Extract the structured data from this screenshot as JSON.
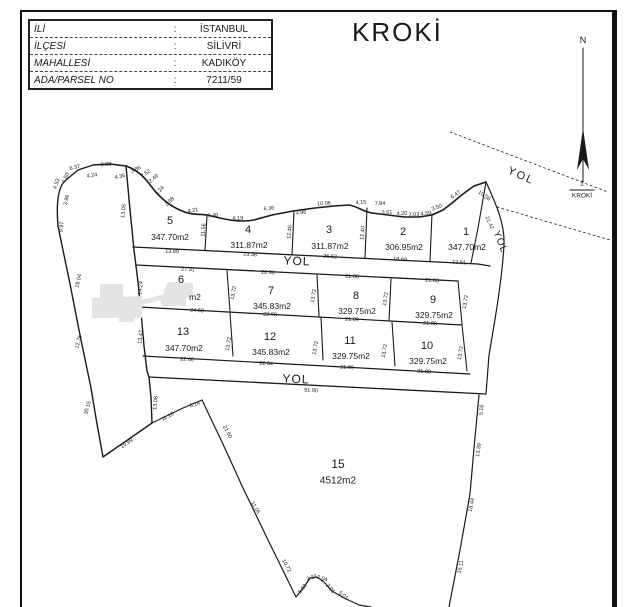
{
  "info_table": {
    "rows": [
      {
        "label": "İLİ",
        "sep": ":",
        "value": "İSTANBUL"
      },
      {
        "label": "İLÇESİ",
        "sep": ":",
        "value": "SİLİVRİ"
      },
      {
        "label": "MAHALLESİ",
        "sep": ":",
        "value": "KADIKÖY"
      },
      {
        "label": "ADA/PARSEL NO",
        "sep": ":",
        "value": "7211/59"
      }
    ]
  },
  "title": "KROKİ",
  "north_label": "N",
  "scale": {
    "numerator": "1",
    "denominator": "KROKİ"
  },
  "colors": {
    "ink": "#1a1a1a",
    "blob": "#e4e4e4",
    "paper": "#ffffff"
  },
  "map": {
    "parcels": [
      {
        "no": "5",
        "area": "347.70m2",
        "nx": 170,
        "ny": 221,
        "ax": 170,
        "ay": 237
      },
      {
        "no": "4",
        "area": "311.87m2",
        "nx": 248,
        "ny": 230,
        "ax": 249,
        "ay": 245
      },
      {
        "no": "3",
        "area": "311.87m2",
        "nx": 329,
        "ny": 230,
        "ax": 330,
        "ay": 246
      },
      {
        "no": "2",
        "area": "306.95m2",
        "nx": 403,
        "ny": 232,
        "ax": 404,
        "ay": 247
      },
      {
        "no": "1",
        "area": "347.70m2",
        "nx": 466,
        "ny": 232,
        "ax": 467,
        "ay": 247
      },
      {
        "no": "6",
        "area": "m2",
        "nx": 181,
        "ny": 280,
        "ax": 195,
        "ay": 297
      },
      {
        "no": "7",
        "area": "345.83m2",
        "nx": 271,
        "ny": 291,
        "ax": 272,
        "ay": 306
      },
      {
        "no": "8",
        "area": "329.75m2",
        "nx": 356,
        "ny": 296,
        "ax": 357,
        "ay": 311
      },
      {
        "no": "9",
        "area": "329.75m2",
        "nx": 433,
        "ny": 300,
        "ax": 434,
        "ay": 315
      },
      {
        "no": "13",
        "area": "347.70m2",
        "nx": 183,
        "ny": 332,
        "ax": 184,
        "ay": 348
      },
      {
        "no": "12",
        "area": "345.83m2",
        "nx": 270,
        "ny": 337,
        "ax": 271,
        "ay": 352
      },
      {
        "no": "11",
        "area": "329.75m2",
        "nx": 350,
        "ny": 341,
        "ax": 351,
        "ay": 356
      },
      {
        "no": "10",
        "area": "329.75m2",
        "nx": 427,
        "ny": 346,
        "ax": 428,
        "ay": 361
      },
      {
        "no": "15",
        "area": "4512m2",
        "nx": 338,
        "ny": 464,
        "ax": 338,
        "ay": 481,
        "ns": 12,
        "as": 10
      }
    ],
    "road_labels": [
      {
        "t": "YOL",
        "x": 297,
        "y": 261,
        "r": 2,
        "s": 12
      },
      {
        "t": "YOL",
        "x": 296,
        "y": 379,
        "r": 2,
        "s": 12
      },
      {
        "t": "YOL",
        "x": 521,
        "y": 176,
        "r": 24,
        "s": 11,
        "ls": 2
      },
      {
        "t": "YOL",
        "x": 500,
        "y": 242,
        "r": 68,
        "s": 10,
        "ls": 1
      }
    ],
    "dim_labels": [
      {
        "t": "6.37",
        "x": 75,
        "y": 168,
        "r": -14
      },
      {
        "t": "3.88",
        "x": 106,
        "y": 165,
        "r": -4
      },
      {
        "t": "4.24",
        "x": 92,
        "y": 176,
        "r": -8
      },
      {
        "t": "4.36",
        "x": 120,
        "y": 177,
        "r": -12
      },
      {
        "t": "3.86",
        "x": 136,
        "y": 170,
        "r": -25
      },
      {
        "t": "2.52",
        "x": 146,
        "y": 174,
        "r": -35
      },
      {
        "t": "2.49",
        "x": 154,
        "y": 179,
        "r": -40
      },
      {
        "t": "4.53",
        "x": 57,
        "y": 184,
        "r": -72
      },
      {
        "t": "1.50",
        "x": 66,
        "y": 178,
        "r": -65
      },
      {
        "t": "3.96",
        "x": 67,
        "y": 200,
        "r": -78
      },
      {
        "t": "9.97",
        "x": 62,
        "y": 227,
        "r": -84
      },
      {
        "t": "19.04",
        "x": 79,
        "y": 281,
        "r": -78
      },
      {
        "t": "12.76",
        "x": 79,
        "y": 342,
        "r": -75
      },
      {
        "t": "30.15",
        "x": 88,
        "y": 408,
        "r": -74
      },
      {
        "t": "3.24",
        "x": 160,
        "y": 191,
        "r": -48
      },
      {
        "t": "2.98",
        "x": 170,
        "y": 202,
        "r": -45
      },
      {
        "t": "4.21",
        "x": 193,
        "y": 211,
        "r": -10
      },
      {
        "t": "7.46",
        "x": 213,
        "y": 216,
        "r": -6
      },
      {
        "t": "8.19",
        "x": 238,
        "y": 219,
        "r": -4
      },
      {
        "t": "6.36",
        "x": 269,
        "y": 209,
        "r": -6
      },
      {
        "t": "3.96",
        "x": 301,
        "y": 213,
        "r": -4
      },
      {
        "t": "10.06",
        "x": 324,
        "y": 204,
        "r": -3
      },
      {
        "t": "4.15",
        "x": 361,
        "y": 203,
        "r": -3
      },
      {
        "t": "7.84",
        "x": 380,
        "y": 204,
        "r": -3
      },
      {
        "t": "3.61",
        "x": 387,
        "y": 213,
        "r": -3
      },
      {
        "t": "4.20",
        "x": 402,
        "y": 214,
        "r": -3
      },
      {
        "t": "2.03",
        "x": 414,
        "y": 215,
        "r": -3
      },
      {
        "t": "4.59",
        "x": 426,
        "y": 214,
        "r": -6
      },
      {
        "t": "3.50",
        "x": 437,
        "y": 208,
        "r": -22
      },
      {
        "t": "6.47",
        "x": 456,
        "y": 195,
        "r": -35
      },
      {
        "t": "10.56",
        "x": 484,
        "y": 196,
        "r": 35
      },
      {
        "t": "13.05",
        "x": 124,
        "y": 211,
        "r": -84
      },
      {
        "t": "11.56",
        "x": 204,
        "y": 230,
        "r": -85
      },
      {
        "t": "12.46",
        "x": 290,
        "y": 232,
        "r": -85
      },
      {
        "t": "12.40",
        "x": 363,
        "y": 233,
        "r": -85
      },
      {
        "t": "13.89",
        "x": 172,
        "y": 252,
        "r": 3
      },
      {
        "t": "23.38",
        "x": 250,
        "y": 255,
        "r": 3
      },
      {
        "t": "26.62",
        "x": 330,
        "y": 257,
        "r": 3
      },
      {
        "t": "18.69",
        "x": 400,
        "y": 260,
        "r": 3
      },
      {
        "t": "12.51",
        "x": 459,
        "y": 263,
        "r": 3
      },
      {
        "t": "27.31",
        "x": 188,
        "y": 270,
        "r": 3
      },
      {
        "t": "22.96",
        "x": 268,
        "y": 273,
        "r": 3
      },
      {
        "t": "21.88",
        "x": 352,
        "y": 277,
        "r": 3
      },
      {
        "t": "21.83",
        "x": 432,
        "y": 281,
        "r": 3
      },
      {
        "t": "14.24",
        "x": 141,
        "y": 288,
        "r": -84
      },
      {
        "t": "13.72",
        "x": 234,
        "y": 293,
        "r": -80
      },
      {
        "t": "13.72",
        "x": 314,
        "y": 296,
        "r": -80
      },
      {
        "t": "13.72",
        "x": 386,
        "y": 299,
        "r": -80
      },
      {
        "t": "13.72",
        "x": 466,
        "y": 302,
        "r": -80
      },
      {
        "t": "24.50",
        "x": 197,
        "y": 311,
        "r": 3
      },
      {
        "t": "22.98",
        "x": 270,
        "y": 315,
        "r": 3
      },
      {
        "t": "21.89",
        "x": 352,
        "y": 320,
        "r": 3
      },
      {
        "t": "21.88",
        "x": 430,
        "y": 324,
        "r": 3
      },
      {
        "t": "13.47",
        "x": 141,
        "y": 337,
        "r": -84
      },
      {
        "t": "13.72",
        "x": 229,
        "y": 344,
        "r": -80
      },
      {
        "t": "13.72",
        "x": 316,
        "y": 348,
        "r": -80
      },
      {
        "t": "13.72",
        "x": 385,
        "y": 351,
        "r": -80
      },
      {
        "t": "13.72",
        "x": 461,
        "y": 353,
        "r": -80
      },
      {
        "t": "22.60",
        "x": 187,
        "y": 360,
        "r": 3
      },
      {
        "t": "22.64",
        "x": 266,
        "y": 364,
        "r": 3
      },
      {
        "t": "21.89",
        "x": 347,
        "y": 368,
        "r": 3
      },
      {
        "t": "21.88",
        "x": 424,
        "y": 372,
        "r": 3
      },
      {
        "t": "91.90",
        "x": 311,
        "y": 391,
        "r": 3
      },
      {
        "t": "21.42",
        "x": 489,
        "y": 223,
        "r": 65
      },
      {
        "t": "13.08",
        "x": 156,
        "y": 403,
        "r": -85
      },
      {
        "t": "10.99",
        "x": 127,
        "y": 444,
        "r": -33
      },
      {
        "t": "11.10",
        "x": 168,
        "y": 417,
        "r": -28
      },
      {
        "t": "6.14",
        "x": 195,
        "y": 405,
        "r": -18
      },
      {
        "t": "21.60",
        "x": 227,
        "y": 432,
        "r": 62
      },
      {
        "t": "11.06",
        "x": 255,
        "y": 508,
        "r": 60
      },
      {
        "t": "10.72",
        "x": 286,
        "y": 566,
        "r": 60
      },
      {
        "t": "5.60",
        "x": 303,
        "y": 589,
        "r": -52
      },
      {
        "t": "2.21",
        "x": 312,
        "y": 578,
        "r": -20
      },
      {
        "t": "2.04",
        "x": 322,
        "y": 579,
        "r": 18
      },
      {
        "t": "3.01",
        "x": 330,
        "y": 589,
        "r": 48
      },
      {
        "t": "5.01",
        "x": 343,
        "y": 596,
        "r": 40
      },
      {
        "t": "5.16",
        "x": 482,
        "y": 410,
        "r": -84
      },
      {
        "t": "13.39",
        "x": 479,
        "y": 450,
        "r": -82
      },
      {
        "t": "16.44",
        "x": 472,
        "y": 505,
        "r": -80
      },
      {
        "t": "15.11",
        "x": 461,
        "y": 567,
        "r": -78
      }
    ]
  }
}
